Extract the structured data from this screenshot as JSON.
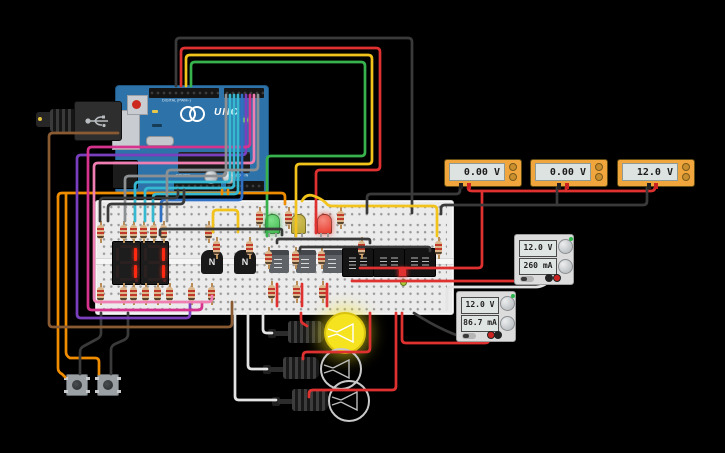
{
  "canvas": {
    "background": "#000000",
    "width": 725,
    "height": 453
  },
  "arduino": {
    "board_name": "UNO",
    "label_digital": "DIGITAL (PWM~)",
    "label_power": "POWER",
    "label_analog": "ANALOG IN",
    "board_color": "#2d72a8",
    "power_led_state": "on"
  },
  "seven_segment_displays": [
    {
      "digit": "1"
    },
    {
      "digit": "1"
    }
  ],
  "transistors": [
    {
      "label": "N"
    },
    {
      "label": "N"
    }
  ],
  "breadboard_leds": [
    {
      "color": "green",
      "hex": "#3db54a",
      "state": "on"
    },
    {
      "color": "yellow",
      "hex": "#b8a636",
      "state": "off"
    },
    {
      "color": "red",
      "hex": "#e8392b",
      "state": "on"
    }
  ],
  "indicator_leds": [
    {
      "shape": "square",
      "hex": "#e03131"
    },
    {
      "shape": "round",
      "hex": "#a8c93a"
    }
  ],
  "multimeters": [
    {
      "value": "0.00 V"
    },
    {
      "value": "0.00 V"
    },
    {
      "value": "12.0 V"
    }
  ],
  "power_supplies": [
    {
      "voltage": "12.0 V",
      "current": "260 mA"
    },
    {
      "voltage": "12.0 V",
      "current": "86.7 mA"
    }
  ],
  "bulbs": [
    {
      "state": "on"
    },
    {
      "state": "off"
    },
    {
      "state": "off"
    }
  ],
  "wire_colors": {
    "black": "#3a3a3a",
    "red": "#e03131",
    "yellow": "#f2c31b",
    "green": "#37b24d",
    "orange": "#f08c00",
    "purple": "#7a3fbf",
    "magenta": "#d6338f",
    "pink": "#ef7fb2",
    "brown": "#8a5a33",
    "cyan": "#35b8d0",
    "blue": "#2f6fc4",
    "gray": "#8d9093",
    "white": "#e4e4e4"
  },
  "resistors": [
    [
      96,
      221
    ],
    [
      119,
      221
    ],
    [
      129,
      221
    ],
    [
      139,
      221
    ],
    [
      149,
      221
    ],
    [
      159,
      221
    ],
    [
      204,
      221
    ],
    [
      212,
      237
    ],
    [
      245,
      237
    ],
    [
      96,
      283
    ],
    [
      119,
      283
    ],
    [
      129,
      283
    ],
    [
      141,
      283
    ],
    [
      153,
      283
    ],
    [
      165,
      283
    ],
    [
      187,
      283
    ],
    [
      207,
      283
    ],
    [
      255,
      207
    ],
    [
      284,
      207
    ],
    [
      336,
      207
    ],
    [
      264,
      247
    ],
    [
      291,
      247
    ],
    [
      317,
      247
    ],
    [
      267,
      281
    ],
    [
      292,
      281
    ],
    [
      318,
      281
    ],
    [
      357,
      237
    ],
    [
      434,
      237
    ]
  ],
  "wires": [
    {
      "name": "wire-arc-black",
      "color": "#3a3a3a",
      "d": "M176,86 L176,42 Q176,38 180,38 L408,38 Q412,38 412,42 L412,213"
    },
    {
      "name": "wire-arc-red",
      "color": "#e03131",
      "d": "M181,86 L181,52 Q181,48 185,48 L376,48 Q380,48 380,52 L380,166 Q380,170 376,170 L320,170 Q316,170 316,174 L316,233"
    },
    {
      "name": "wire-arc-yellow",
      "color": "#f2c31b",
      "d": "M186,86 L186,59 Q186,55 190,55 L368,55 Q372,55 372,59 L372,160 Q372,164 368,164 L300,164 Q296,164 296,168 L296,236"
    },
    {
      "name": "wire-arc-green",
      "color": "#37b24d",
      "d": "M191,86 L191,66 Q191,62 195,62 L361,62 Q365,62 365,66 L365,152 Q365,156 361,156 L271,156 Q267,156 267,160 L267,236"
    },
    {
      "name": "wire-yellow-b",
      "color": "#f2c31b",
      "d": "M302,201 Q306,193 314,196 Q322,199 326,203 Q328,206 332,206 L433,206 Q437,206 437,210 L437,236"
    },
    {
      "name": "wire-yellow-c",
      "color": "#f2c31b",
      "d": "M213,232 L213,214 Q213,210 217,210 L234,210 Q238,210 238,214 L238,232"
    },
    {
      "name": "wire-mm-red-bus",
      "color": "#e03131",
      "d": "M468,185 L468,187 Q468,191 472,191 L651,191 Q655,191 655,187 L655,185"
    },
    {
      "name": "wire-mm2-red-stub",
      "color": "#e03131",
      "d": "M566,185 L566,191"
    },
    {
      "name": "wire-red-drop",
      "color": "#e03131",
      "d": "M482,191 L482,264 Q482,268 478,268 L450,268"
    },
    {
      "name": "wire-board-red-a",
      "color": "#e03131",
      "d": "M360,268 L450,268"
    },
    {
      "name": "wire-mm1-black",
      "color": "#3a3a3a",
      "d": "M460,185 L460,190 Q460,194 456,194 L371,194 Q367,194 367,198 L367,213"
    },
    {
      "name": "wire-mm3-black",
      "color": "#3a3a3a",
      "d": "M647,185 L647,201 Q647,205 643,205 L445,205 Q441,205 441,209 L441,214"
    },
    {
      "name": "wire-mm2-black",
      "color": "#3a3a3a",
      "d": "M557,185 L557,205"
    },
    {
      "name": "wire-board-red-b",
      "color": "#e03131",
      "d": "M352,281 L553,281 Q557,281 557,280"
    },
    {
      "name": "wire-psu1-white",
      "color": "#e4e4e4",
      "d": "M550,280 Q544,287 536,287 L452,287 Q447,287 447,291 L447,309"
    },
    {
      "name": "wire-psu2-red",
      "color": "#e03131",
      "d": "M489,337 L489,339 Q489,343 485,343 L406,343 Q402,343 402,339 L402,313"
    },
    {
      "name": "wire-psu2-black",
      "color": "#3a3a3a",
      "d": "M414,313 C434,326 458,338 476,340 C486,341 494,340 496,337"
    },
    {
      "name": "wire-bulb1-red",
      "color": "#e03131",
      "d": "M301,313 L301,319 Q301,323 304,324 L307,326"
    },
    {
      "name": "wire-bulb2-red",
      "color": "#e03131",
      "d": "M370,313 L370,348 Q370,352 366,352 L307,352 Q303,352 303,356 L303,359"
    },
    {
      "name": "wire-bulb3-red",
      "color": "#e03131",
      "d": "M396,313 L396,386 Q396,390 392,390 L313,390 Q309,390 309,394 L309,397"
    },
    {
      "name": "wire-bulb1-white",
      "color": "#e4e4e4",
      "d": "M272,333 L267,333 Q263,333 263,329 L263,313"
    },
    {
      "name": "wire-bulb2-white",
      "color": "#e4e4e4",
      "d": "M267,369 L252,369 Q248,369 248,365 L248,313"
    },
    {
      "name": "wire-bulb3-white",
      "color": "#e4e4e4",
      "d": "M276,400 L239,400 Q235,400 235,396 L235,313"
    },
    {
      "name": "wire-orange-main",
      "color": "#f08c00",
      "d": "M58,197 Q58,193 62,193 L281,193 Q285,193 285,197 L285,204"
    },
    {
      "name": "wire-btn1-orange",
      "color": "#f08c00",
      "d": "M58,197 L58,368 Q58,372 62,374 L65,377"
    },
    {
      "name": "wire-btn2-orange",
      "color": "#f08c00",
      "d": "M66,194 L66,352 Q66,356 70,358 L95,358 Q99,358 99,362 L99,374"
    },
    {
      "name": "wire-btn1-black",
      "color": "#3a3a3a",
      "d": "M80,374 L80,352 Q80,348 84,346 L97,339 Q101,337 101,333 L101,313"
    },
    {
      "name": "wire-btn2-black",
      "color": "#3a3a3a",
      "d": "M111,374 L111,350 Q111,346 115,344 L124,340 Q128,338 128,334 L128,313"
    },
    {
      "name": "wire-brown",
      "color": "#8a5a33",
      "d": "M118,133 L53,133 Q49,133 49,137 L49,323 Q49,327 53,327 L228,327 Q232,327 232,323 L232,302"
    },
    {
      "name": "wire-purple",
      "color": "#7a3fbf",
      "d": "M246,95 L246,151 Q246,155 242,155 L81,155 Q77,155 77,159 L77,314 Q77,318 81,318 L186,318 Q190,318 190,314 L190,302"
    },
    {
      "name": "wire-magenta",
      "color": "#d6338f",
      "d": "M250,95 L250,143 Q250,147 246,147 L92,147 Q88,147 88,151 L88,306 Q88,310 92,310 L198,310 Q202,310 202,306 L202,302"
    },
    {
      "name": "wire-pink",
      "color": "#ef7fb2",
      "d": "M254,95 L254,159 Q254,163 250,163 L98,163 Q94,163 94,167 L94,298 Q94,302 98,302 L208,302 Q212,302 212,298 L212,296"
    },
    {
      "name": "wire-gray1",
      "color": "#8d9093",
      "d": "M226,95 L226,172 Q226,176 222,176 L129,176 Q125,176 125,180 L125,221"
    },
    {
      "name": "wire-cyan1",
      "color": "#35b8d0",
      "d": "M230,95 L230,178 Q230,182 226,182 L139,182 Q135,182 135,186 L135,221"
    },
    {
      "name": "wire-cyan2",
      "color": "#35b8d0",
      "d": "M234,95 L234,184 Q234,188 230,188 L149,188 Q145,188 145,192 L145,221"
    },
    {
      "name": "wire-cyan3",
      "color": "#35b8d0",
      "d": "M238,95 L238,190 Q238,194 234,194 L157,194 Q153,194 153,198 L153,221"
    },
    {
      "name": "wire-blue",
      "color": "#2f6fc4",
      "d": "M242,95 L242,196 Q242,200 238,200 L165,200 Q161,200 161,204 L161,221"
    },
    {
      "name": "wire-gray2",
      "color": "#8d9093",
      "d": "M258,95 L258,166 Q258,170 254,170 L171,170 Q167,170 167,174 L167,221"
    },
    {
      "name": "wire-gnd-black1",
      "color": "#3a3a3a",
      "d": "M178,190 L178,194 Q178,198 174,198 L104,198 Q100,198 100,202 L100,221"
    },
    {
      "name": "wire-gnd-black2",
      "color": "#3a3a3a",
      "d": "M184,190 L184,200 Q184,204 180,204 L112,204 Q108,204 108,208 L108,221"
    },
    {
      "name": "wire-jumper1",
      "color": "#3a3a3a",
      "d": "M160,235 L160,231 Q160,229 162,229 L280,229 Q282,229 282,231 L282,235"
    },
    {
      "name": "wire-jumper2",
      "color": "#3a3a3a",
      "d": "M277,243 L277,241 Q277,239 279,239 L368,239 Q370,239 370,241 L370,243"
    },
    {
      "name": "wire-jumper3",
      "color": "#3a3a3a",
      "d": "M300,251 L300,249 Q300,247 302,247 L428,247 Q430,247 430,249 L430,251"
    },
    {
      "name": "wire-red-stub1",
      "color": "#e03131",
      "d": "M277,284 L277,306"
    },
    {
      "name": "wire-red-stub2",
      "color": "#e03131",
      "d": "M302,284 L302,306"
    },
    {
      "name": "wire-red-stub3",
      "color": "#e03131",
      "d": "M327,284 L327,306"
    },
    {
      "name": "wire-orange-stub1",
      "color": "#f08c00",
      "d": "M222,190 L222,194"
    },
    {
      "name": "wire-orange-stub2",
      "color": "#f08c00",
      "d": "M228,190 L228,194"
    }
  ]
}
